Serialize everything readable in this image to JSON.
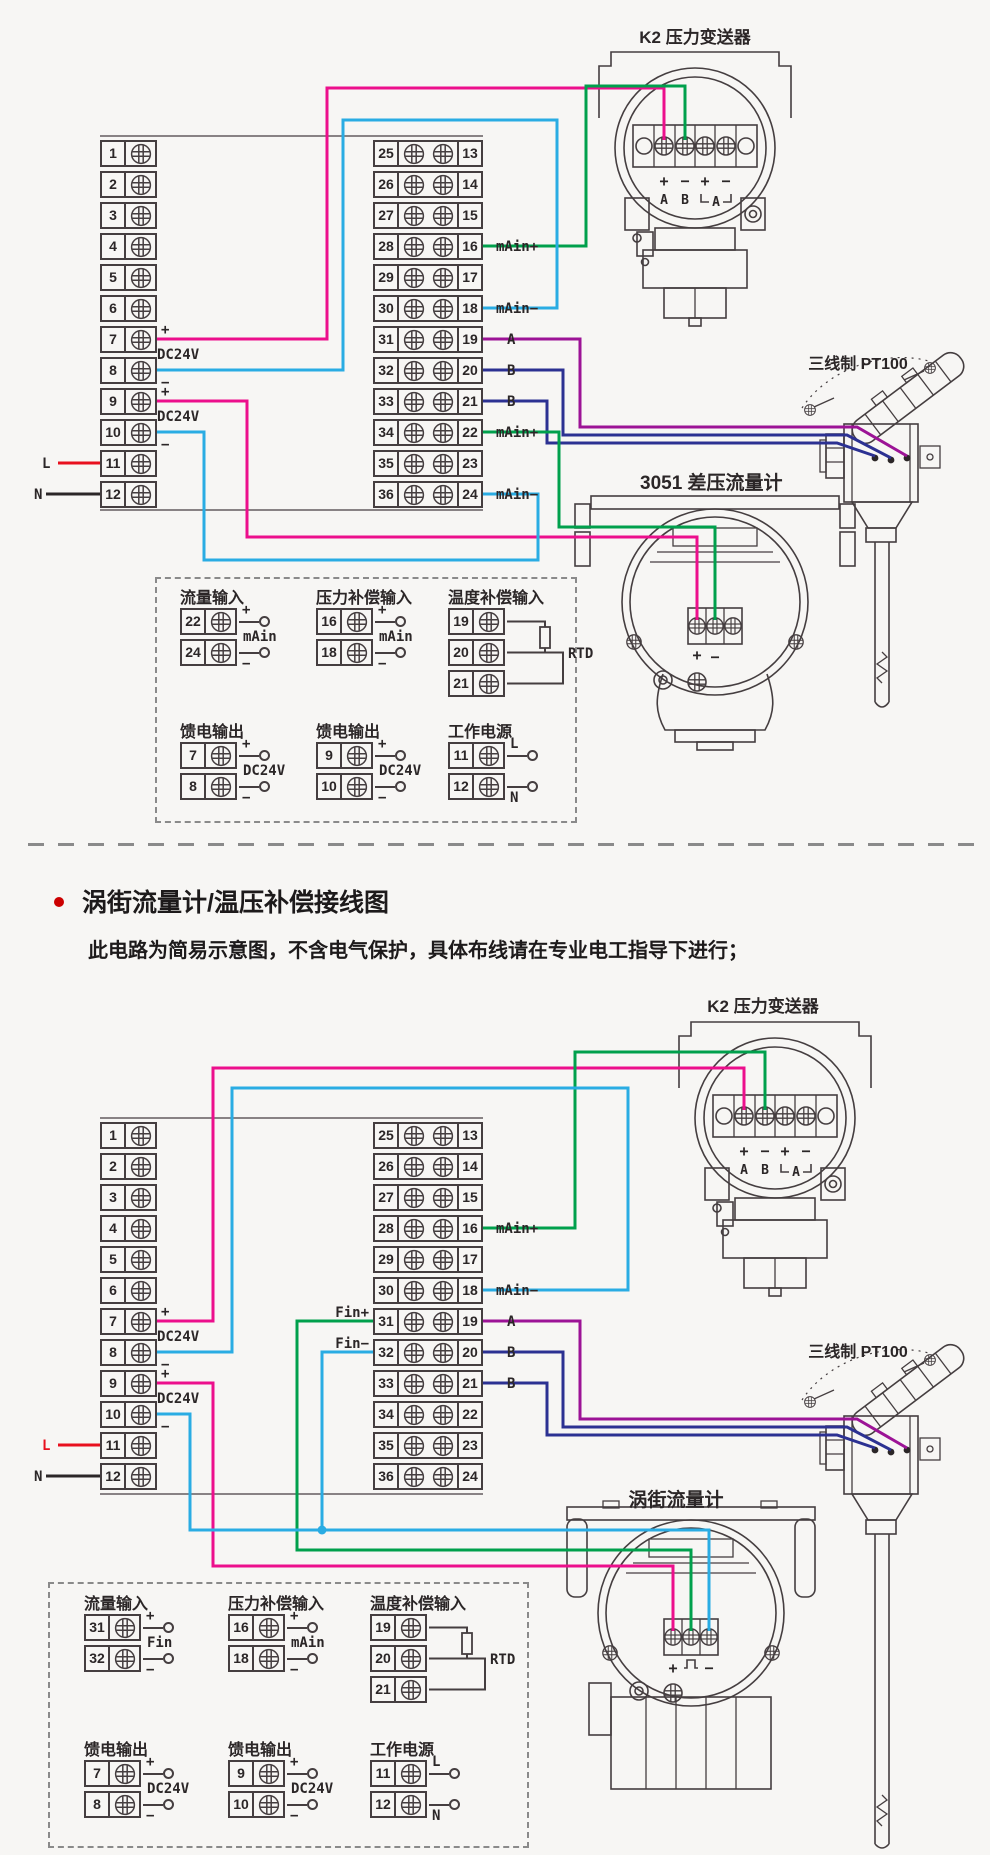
{
  "meta": {
    "bg": "#f7f6f4",
    "ink": "#453e40",
    "text": "#2b2627",
    "bullet_color": "#cc0000"
  },
  "wire_colors": {
    "magenta": "#ec0f8c",
    "cyan": "#2aace3",
    "green": "#00a04c",
    "purple": "#9c1396",
    "navy": "#2c3192",
    "red": "#e8101e",
    "black": "#2b2627"
  },
  "section_note": {
    "title": "涡街流量计/温压补偿接线图",
    "note": "此电路为简易示意图，不含电气保护，具体布线请在专业电工指导下进行；"
  },
  "k2_strip": {
    "pm": [
      "+",
      "−",
      "+",
      "−"
    ],
    "ab": [
      "A",
      "B"
    ],
    "arrow": "A"
  },
  "d1": {
    "k2_label": "K2 压力变送器",
    "pt100_label": "三线制 PT100",
    "meter_label": "3051 差压流量计",
    "meter_plus": "+",
    "meter_minus": "−",
    "left_numbers": [
      "1",
      "2",
      "3",
      "4",
      "5",
      "6",
      "7",
      "8",
      "9",
      "10",
      "11",
      "12"
    ],
    "right_numbers_left": [
      "25",
      "26",
      "27",
      "28",
      "29",
      "30",
      "31",
      "32",
      "33",
      "34",
      "35",
      "36"
    ],
    "right_numbers_right": [
      "13",
      "14",
      "15",
      "16",
      "17",
      "18",
      "19",
      "20",
      "21",
      "22",
      "23",
      "24"
    ],
    "dc1": {
      "plus": "+",
      "label": "DC24V",
      "minus": "−"
    },
    "dc2": {
      "plus": "+",
      "label": "DC24V",
      "minus": "−"
    },
    "l": "L",
    "n": "N",
    "right_labels": [
      {
        "row": 3,
        "text": "mAin+"
      },
      {
        "row": 5,
        "text": "mAin−"
      },
      {
        "row": 6,
        "text": "A"
      },
      {
        "row": 7,
        "text": "B"
      },
      {
        "row": 8,
        "text": "B"
      },
      {
        "row": 9,
        "text": "mAin+"
      },
      {
        "row": 11,
        "text": "mAin−"
      }
    ],
    "legend_row1": [
      {
        "type": "io",
        "title": "流量输入",
        "rows": [
          [
            "22",
            "+"
          ],
          [
            "24",
            "−"
          ]
        ],
        "mid": "mAin"
      },
      {
        "type": "io",
        "title": "压力补偿输入",
        "rows": [
          [
            "16",
            "+"
          ],
          [
            "18",
            "−"
          ]
        ],
        "mid": "mAin"
      },
      {
        "type": "rtd",
        "title": "温度补偿输入",
        "nums": [
          "19",
          "20",
          "21"
        ],
        "mid": "RTD"
      }
    ],
    "legend_row2": [
      {
        "type": "io",
        "title": "馈电输出",
        "rows": [
          [
            "7",
            "+"
          ],
          [
            "8",
            "−"
          ]
        ],
        "mid": "DC24V"
      },
      {
        "type": "io",
        "title": "馈电输出",
        "rows": [
          [
            "9",
            "+"
          ],
          [
            "10",
            "−"
          ]
        ],
        "mid": "DC24V"
      },
      {
        "type": "io",
        "title": "工作电源",
        "rows": [
          [
            "11",
            "L"
          ],
          [
            "12",
            "N"
          ]
        ],
        "mid": ""
      }
    ]
  },
  "d2": {
    "k2_label": "K2 压力变送器",
    "pt100_label": "三线制 PT100",
    "meter_label": "涡街流量计",
    "meter_plus": "+",
    "meter_minus": "−",
    "left_numbers": [
      "1",
      "2",
      "3",
      "4",
      "5",
      "6",
      "7",
      "8",
      "9",
      "10",
      "11",
      "12"
    ],
    "right_numbers_left": [
      "25",
      "26",
      "27",
      "28",
      "29",
      "30",
      "31",
      "32",
      "33",
      "34",
      "35",
      "36"
    ],
    "right_numbers_right": [
      "13",
      "14",
      "15",
      "16",
      "17",
      "18",
      "19",
      "20",
      "21",
      "22",
      "23",
      "24"
    ],
    "dc1": {
      "plus": "+",
      "label": "DC24V",
      "minus": "−"
    },
    "dc2": {
      "plus": "+",
      "label": "DC24V",
      "minus": "−"
    },
    "l": "L",
    "n": "N",
    "fin_labels": [
      {
        "row": 6,
        "text": "Fin+"
      },
      {
        "row": 7,
        "text": "Fin−"
      }
    ],
    "right_labels": [
      {
        "row": 3,
        "text": "mAin+"
      },
      {
        "row": 5,
        "text": "mAin−"
      },
      {
        "row": 6,
        "text": "A"
      },
      {
        "row": 7,
        "text": "B"
      },
      {
        "row": 8,
        "text": "B"
      }
    ],
    "legend_row1": [
      {
        "type": "io",
        "title": "流量输入",
        "rows": [
          [
            "31",
            "+"
          ],
          [
            "32",
            "−"
          ]
        ],
        "mid": "Fin"
      },
      {
        "type": "io",
        "title": "压力补偿输入",
        "rows": [
          [
            "16",
            "+"
          ],
          [
            "18",
            "−"
          ]
        ],
        "mid": "mAin"
      },
      {
        "type": "rtd",
        "title": "温度补偿输入",
        "nums": [
          "19",
          "20",
          "21"
        ],
        "mid": "RTD"
      }
    ],
    "legend_row2": [
      {
        "type": "io",
        "title": "馈电输出",
        "rows": [
          [
            "7",
            "+"
          ],
          [
            "8",
            "−"
          ]
        ],
        "mid": "DC24V"
      },
      {
        "type": "io",
        "title": "馈电输出",
        "rows": [
          [
            "9",
            "+"
          ],
          [
            "10",
            "−"
          ]
        ],
        "mid": "DC24V"
      },
      {
        "type": "io",
        "title": "工作电源",
        "rows": [
          [
            "11",
            "L"
          ],
          [
            "12",
            "N"
          ]
        ],
        "mid": ""
      }
    ]
  }
}
